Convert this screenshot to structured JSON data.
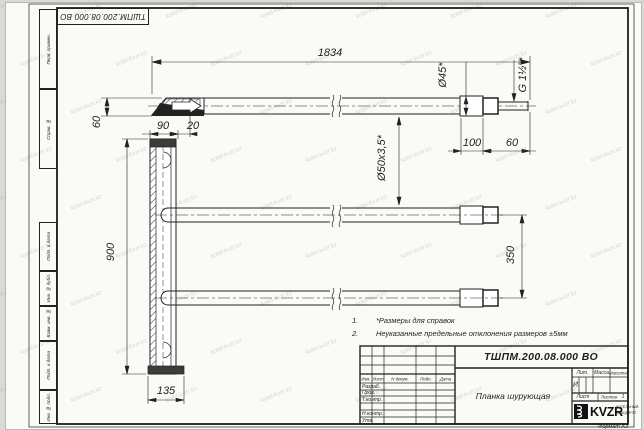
{
  "stamp_top": "ТШПМ.200.08.000 ВО",
  "watermark": {
    "text": "kotel-kvzr.kz"
  },
  "margin_boxes": [
    "Перв. примен.",
    "Справ. №",
    "Подп. и дата",
    "Инв. № дубл.",
    "Взам. инв. №",
    "Подп. и дата",
    "Инв. № подл."
  ],
  "dims": {
    "total_length": "1834",
    "blade_drop": "60",
    "coupler_dia": "Ø45*",
    "thread": "G 1½\"*",
    "coupler_len": "100",
    "thread_len": "60",
    "pipe_spec": "Ø50х3,5*",
    "plate_width": "90",
    "blade_offset": "20",
    "plate_height": "900",
    "pipe_spacing": "350",
    "base_width": "135"
  },
  "notes": [
    {
      "num": "1.",
      "text": "*Размеры для справок"
    },
    {
      "num": "2.",
      "text": "Неуказанные предельные отклонения размеров ±5мм"
    }
  ],
  "title_block": {
    "doc_number": "ТШПМ.200.08.000 ВО",
    "part_name": "Планка шурующая",
    "header_cols": [
      "Изм.",
      "Лист",
      "N докум.",
      "Подп.",
      "Дата"
    ],
    "rows": [
      "Разраб.",
      "Пров.",
      "Т.контр.",
      "Н.контр.",
      "Утв."
    ],
    "lit_label": "Лит.",
    "lit_value": "И",
    "mass_label": "Масса",
    "scale_label": "Масштаб",
    "sheet_label": "Лист",
    "sheets_label": "Листов",
    "sheets_value": "1",
    "company": "KVZR",
    "company_sub1": "КОТЕЛЬНЫЙ",
    "company_sub2": "ЗАВОД РЭТ",
    "format_label": "Формат А3"
  }
}
